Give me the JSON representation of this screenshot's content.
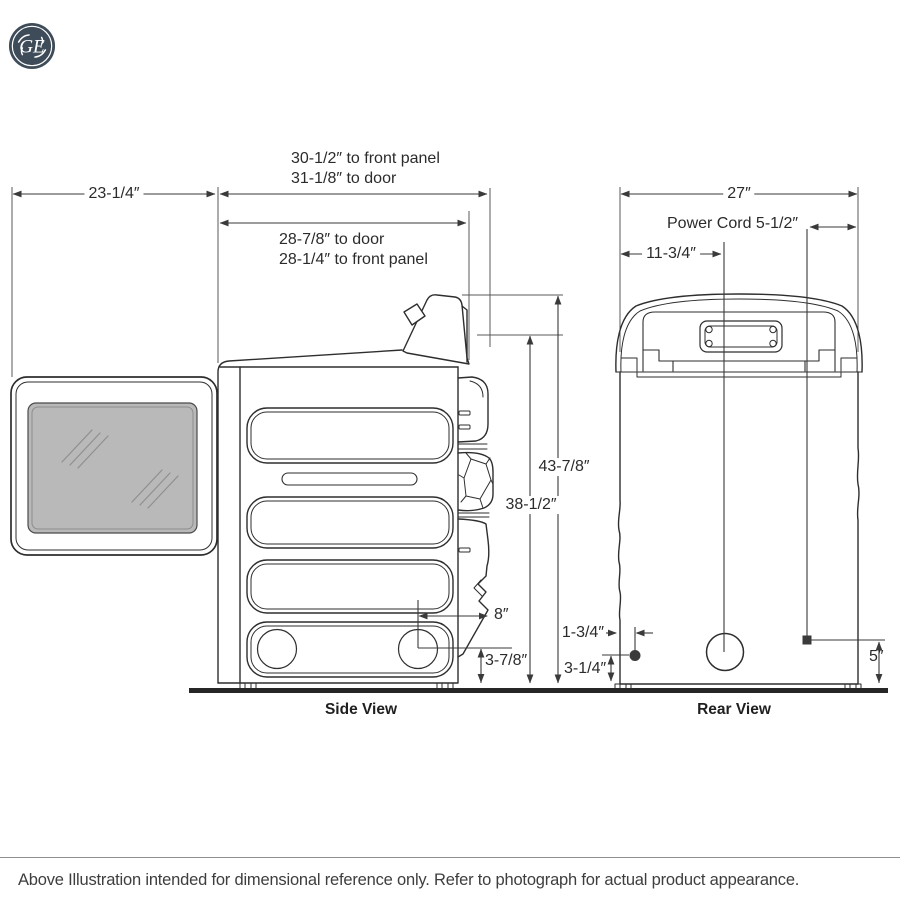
{
  "logo": {
    "monogram": "GE"
  },
  "diagram": {
    "side_view": {
      "label": "Side View",
      "dimensions": {
        "door_swing_width": "23-1/4″",
        "depth_to_front_panel": "30-1/2″ to front panel",
        "depth_to_door": "31-1/8″ to door",
        "depth_rear_to_door": "28-7/8″ to door",
        "depth_rear_to_front_panel": "28-1/4″ to front panel",
        "height_to_console_top": "43-7/8″",
        "height_to_body_top": "38-1/2″",
        "leg_to_rear_offset": "8″",
        "leg_center_height": "3-7/8″"
      }
    },
    "rear_view": {
      "label": "Rear View",
      "dimensions": {
        "width": "27″",
        "power_cord": "Power Cord 5-1/2″",
        "cord_from_left": "11-3/4″",
        "cord_edge_inset": "1-3/4″",
        "cord_exit_height": "3-1/4″",
        "outlet_height": "5″"
      }
    }
  },
  "footer": {
    "note": "Above Illustration intended for dimensional reference only. Refer to photograph for actual product appearance."
  },
  "colors": {
    "line": "#2e2e2e",
    "dim_line": "#3a3a3a",
    "window_fill": "#b9b9b9",
    "logo_bg": "#3E4C59",
    "floor": "#262626"
  }
}
